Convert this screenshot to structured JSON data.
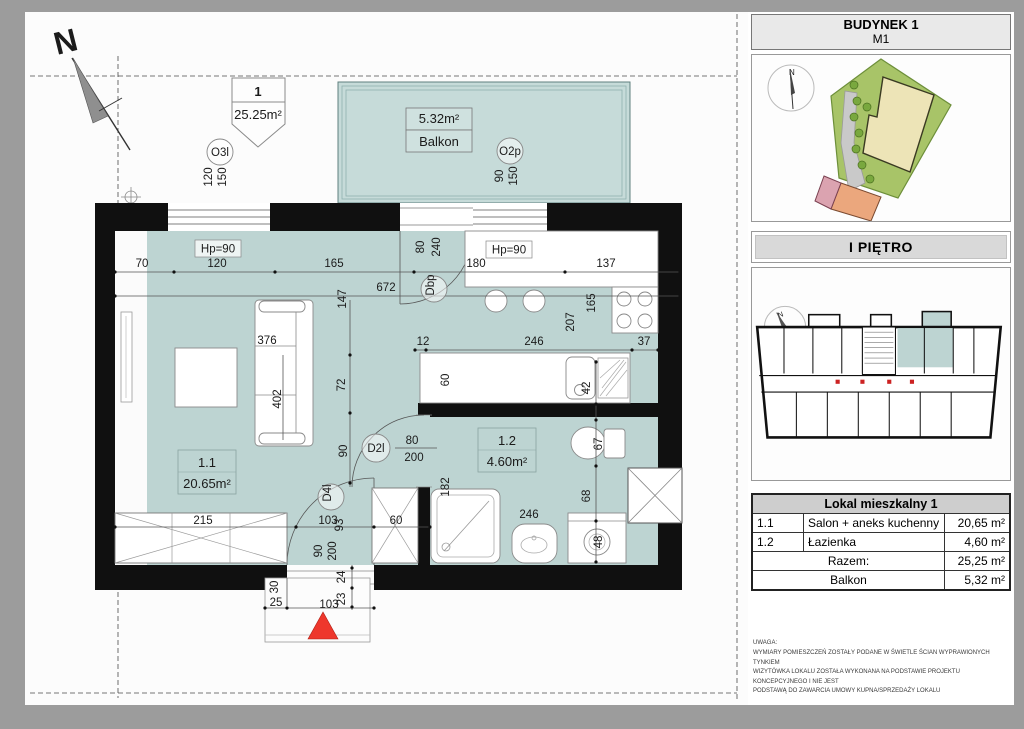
{
  "compass_label": "N",
  "unit_marker": {
    "number": "1",
    "area": "25.25m²"
  },
  "balcony": {
    "area": "5.32m²",
    "name": "Balkon"
  },
  "rooms": {
    "living": {
      "id": "1.1",
      "area": "20.65m²"
    },
    "bath": {
      "id": "1.2",
      "area": "4.60m²"
    }
  },
  "openings": {
    "o3l": "O3l",
    "o2p": "O2p",
    "dbp": "Dbp",
    "d2l": "D2l",
    "d4l": "D4l",
    "hp_left": "Hp=90",
    "hp_right": "Hp=90"
  },
  "dims": [
    "70",
    "120",
    "165",
    "180",
    "137",
    "672",
    "147",
    "80",
    "240",
    "120",
    "150",
    "90",
    "150",
    "376",
    "402",
    "72",
    "90",
    "12",
    "246",
    "37",
    "165",
    "207",
    "60",
    "42",
    "67",
    "68",
    "48",
    "182",
    "246",
    "80",
    "200",
    "215",
    "103",
    "93",
    "90",
    "200",
    "60",
    "30",
    "25",
    "23",
    "24",
    "103"
  ],
  "panel": {
    "building": "BUDYNEK 1",
    "unit": "M1",
    "floor": "I PIĘTRO",
    "compass_label": "N",
    "table": {
      "title": "Lokal mieszkalny 1",
      "rows": [
        {
          "no": "1.1",
          "name": "Salon + aneks kuchenny",
          "area": "20,65 m²"
        },
        {
          "no": "1.2",
          "name": "Łazienka",
          "area": "4,60 m²"
        }
      ],
      "total_label": "Razem:",
      "total_area": "25,25 m²",
      "balcony_label": "Balkon",
      "balcony_area": "5,32 m²"
    },
    "note_title": "UWAGA:",
    "note_lines": [
      "WYMIARY POMIESZCZEŃ ZOSTAŁY PODANE W ŚWIETLE ŚCIAN WYPRAWIONYCH TYNKIEM",
      "WIZYTÓWKA LOKALU ZOSTAŁA WYKONANA NA PODSTAWIE PROJEKTU KONCEPCYJNEGO I NIE JEST",
      "PODSTAWĄ DO ZAWARCIA UMOWY KUPNA/SPRZEDAŻY LOKALU"
    ]
  }
}
